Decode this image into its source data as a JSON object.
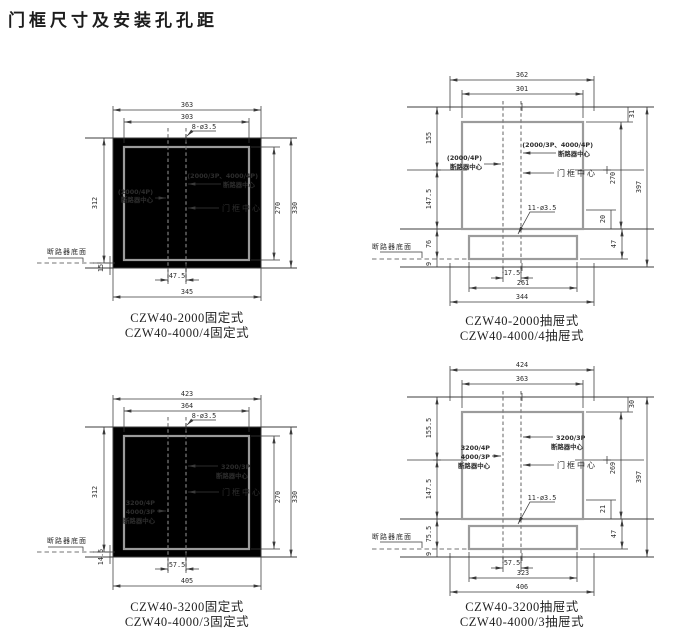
{
  "title": "门框尺寸及安装孔孔距",
  "colors": {
    "line": "#3a3a3a",
    "frame_gray": "#9b9b9b"
  },
  "d1": {
    "captions": [
      "CZW40-2000固定式",
      "CZW40-4000/4固定式"
    ],
    "hole": "8-ø3.5",
    "dim": {
      "w_outer": "363",
      "w_frame": "303",
      "h_left": "312",
      "h_frame": "270",
      "h_outer": "330",
      "off": "47.5",
      "w_bottom": "345",
      "base": "15"
    },
    "lbl": {
      "c1": "(2000/3P、4000/4P)",
      "c2": "断路器中心",
      "l1": "(2000/4P)",
      "l2": "断路器中心",
      "fc": "门框中心",
      "base": "断路器底面"
    }
  },
  "d2": {
    "captions": [
      "CZW40-2000抽屉式",
      "CZW40-4000/4抽屉式"
    ],
    "hole": "11-ø3.5",
    "dim": {
      "w_outer": "362",
      "w_frame": "301",
      "l1": "155",
      "l2": "147.5",
      "l3": "76",
      "l4": "9",
      "r1": "31",
      "r2": "270",
      "r3": "397",
      "r4": "20",
      "r5": "47",
      "off": "17.5",
      "w_ap": "261",
      "w_bottom": "344"
    },
    "lbl": {
      "c1": "(2000/3P、4000/4P)",
      "c2": "断路器中心",
      "l1": "(2000/4P)",
      "l2": "断路器中心",
      "fc": "门框中心",
      "base": "断路器底面"
    }
  },
  "d3": {
    "captions": [
      "CZW40-3200固定式",
      "CZW40-4000/3固定式"
    ],
    "hole": "8-ø3.5",
    "dim": {
      "w_outer": "423",
      "w_frame": "364",
      "h_left": "312",
      "h_frame": "270",
      "h_outer": "330",
      "off": "57.5",
      "w_bottom": "405",
      "base": "14.5"
    },
    "lbl": {
      "c1": "3200/3P",
      "c2": "断路器中心",
      "l1": "3200/4P",
      "l2": "4000/3P",
      "l3": "断路器中心",
      "fc": "门框中心",
      "base": "断路器底面"
    }
  },
  "d4": {
    "captions": [
      "CZW40-3200抽屉式",
      "CZW40-4000/3抽屉式"
    ],
    "hole": "11-ø3.5",
    "dim": {
      "w_outer": "424",
      "w_frame": "363",
      "l1": "155.5",
      "l2": "147.5",
      "l3": "75.5",
      "l4": "9",
      "r1": "30",
      "r2": "269",
      "r3": "397",
      "r4": "21",
      "r5": "47",
      "off": "57.5",
      "w_ap": "323",
      "w_bottom": "406"
    },
    "lbl": {
      "c1": "3200/3P",
      "c2": "断路器中心",
      "l1": "3200/4P",
      "l2": "4000/3P",
      "l3": "断路器中心",
      "fc": "门框中心",
      "base": "断路器底面"
    }
  }
}
